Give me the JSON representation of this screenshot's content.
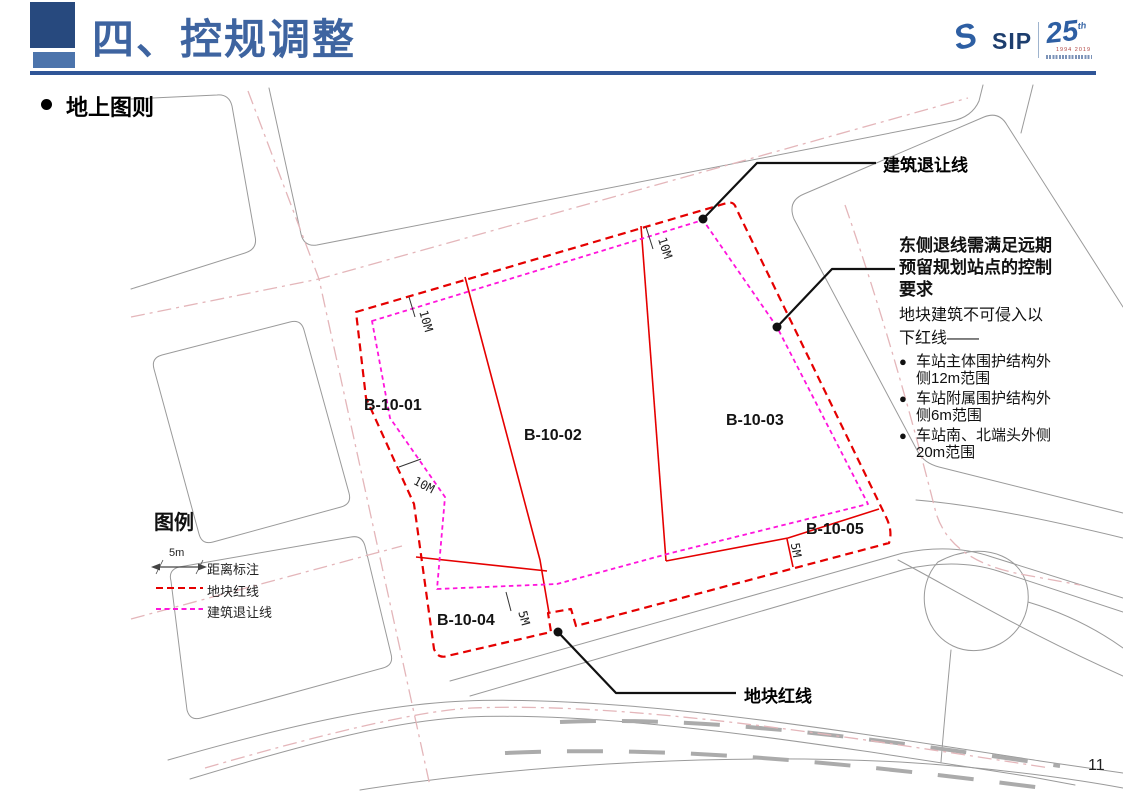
{
  "header": {
    "title": "四、控规调整"
  },
  "logo": {
    "brand": "SIP",
    "anniversary": "25",
    "anniversary_suffix": "th",
    "years": "1994 2019"
  },
  "section": {
    "title": "地上图则"
  },
  "map": {
    "parcels": [
      {
        "id": "B-10-01"
      },
      {
        "id": "B-10-02"
      },
      {
        "id": "B-10-03"
      },
      {
        "id": "B-10-04"
      },
      {
        "id": "B-10-05"
      }
    ],
    "dimensions": [
      {
        "label": "10M"
      },
      {
        "label": "10M"
      },
      {
        "label": "10M"
      },
      {
        "label": "5M"
      },
      {
        "label": "5M"
      }
    ],
    "callouts": {
      "setback": "建筑退让线",
      "redline": "地块红线"
    },
    "note": {
      "title": "东侧退线需满足远期预留规划站点的控制要求",
      "body": "地块建筑不可侵入以下红线——",
      "bullet_char": "●",
      "bullets": [
        "车站主体围护结构外侧12m范围",
        "车站附属围护结构外侧6m范围",
        "车站南、北端头外侧20m范围"
      ]
    },
    "legend": {
      "title": "图例",
      "scale_value": "5m",
      "items": [
        {
          "label": "距离标注"
        },
        {
          "label": "地块红线"
        },
        {
          "label": "建筑退让线"
        }
      ]
    },
    "colors": {
      "redline": "#E50000",
      "setback": "#FF14DC",
      "road": "#8A8A8A",
      "centerline": "#E4B6BA",
      "accent": "#3E64A0"
    }
  },
  "footer": {
    "page_number": "11"
  }
}
